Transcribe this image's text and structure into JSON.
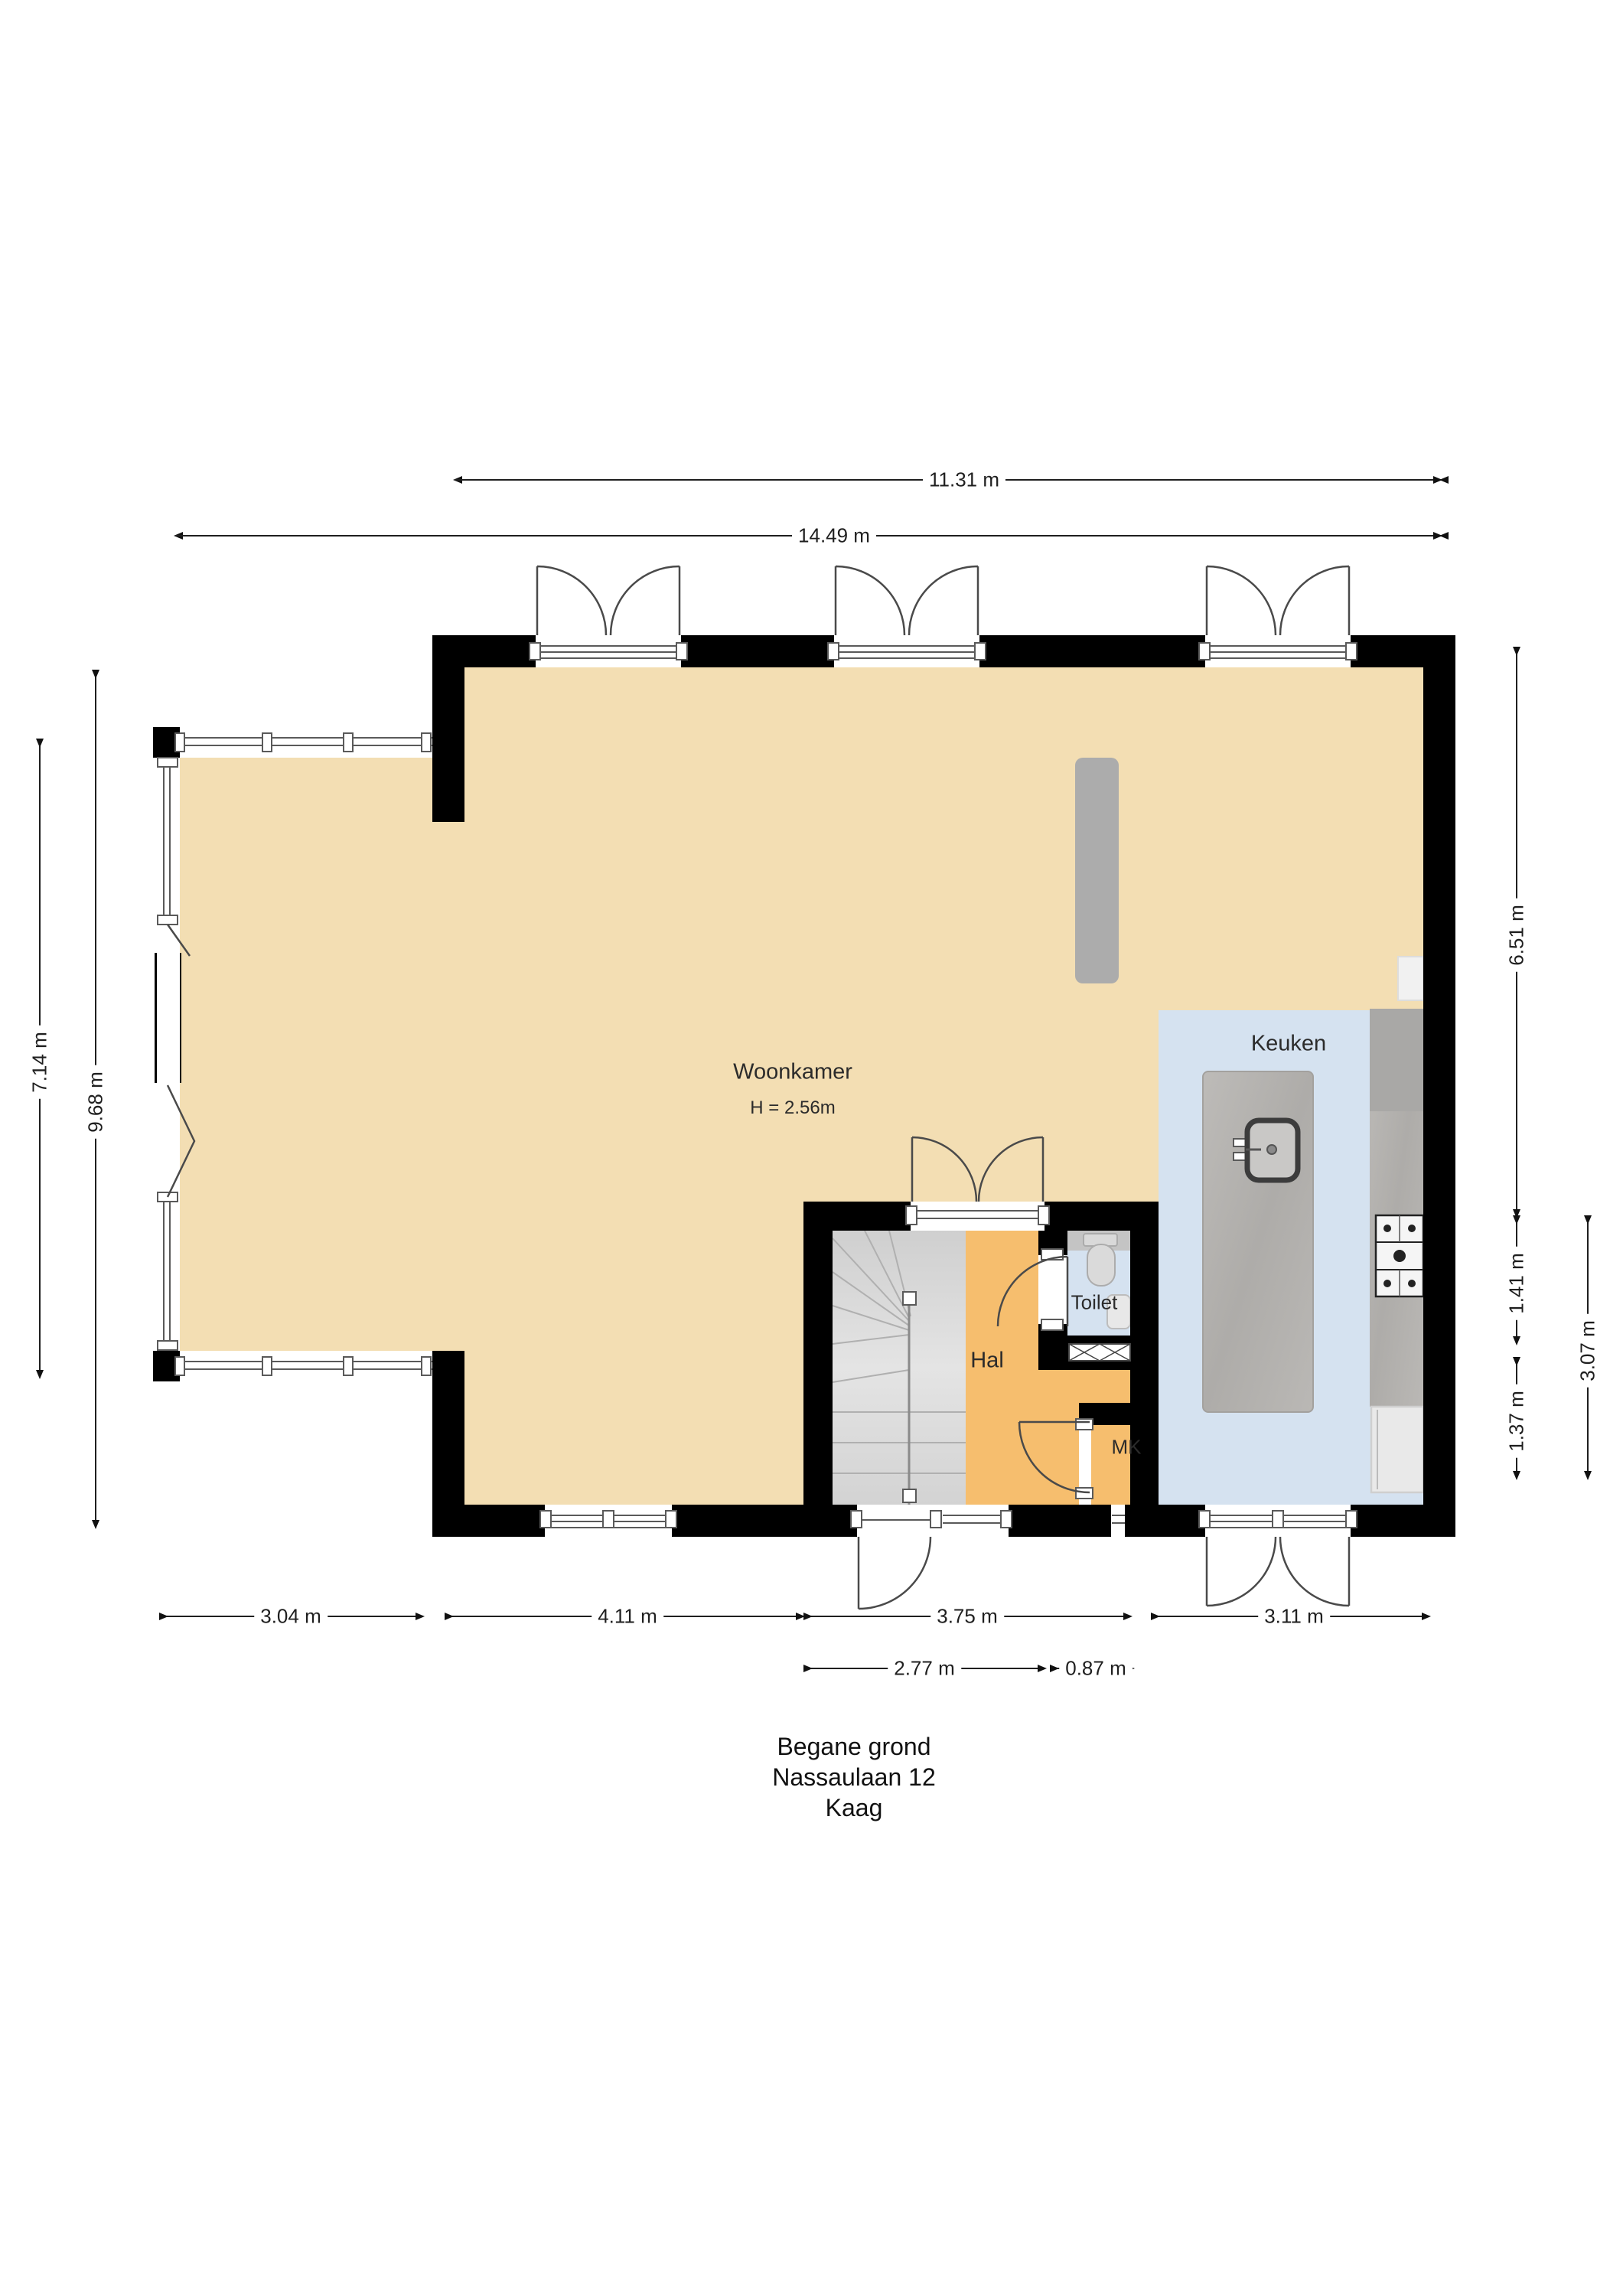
{
  "title_block": {
    "line1": "Begane grond",
    "line2": "Nassaulaan 12",
    "line3": "Kaag"
  },
  "rooms": {
    "woonkamer": {
      "name": "Woonkamer",
      "height_note": "H = 2.56m"
    },
    "keuken": {
      "name": "Keuken"
    },
    "hal": {
      "name": "Hal"
    },
    "toilet": {
      "name": "Toilet"
    },
    "mk": {
      "name": "MK"
    }
  },
  "dimensions": {
    "top_inner": "11.31 m",
    "top_outer": "14.49 m",
    "left_outer": "7.14 m",
    "left_inner": "9.68 m",
    "right_top": "6.51 m",
    "right_mid": "1.41 m",
    "right_low": "1.37 m",
    "right_outer": "3.07 m",
    "bottom_1": "3.04 m",
    "bottom_2": "4.11 m",
    "bottom_3": "3.75 m",
    "bottom_4": "3.11 m",
    "bottom_sub_1": "2.77 m",
    "bottom_sub_2": "0.87 m"
  },
  "colors": {
    "wall": "#000000",
    "tan": "#F3DEB3",
    "orange": "#F6BE6E",
    "blue": "#D5E2F0",
    "stairs": "#DCDCDC",
    "counter": "#B5B3B0",
    "fixture": "#ACACAC",
    "line": "#4A4A4A",
    "dim": "#1F1F1F",
    "text": "#1A1A1A"
  }
}
